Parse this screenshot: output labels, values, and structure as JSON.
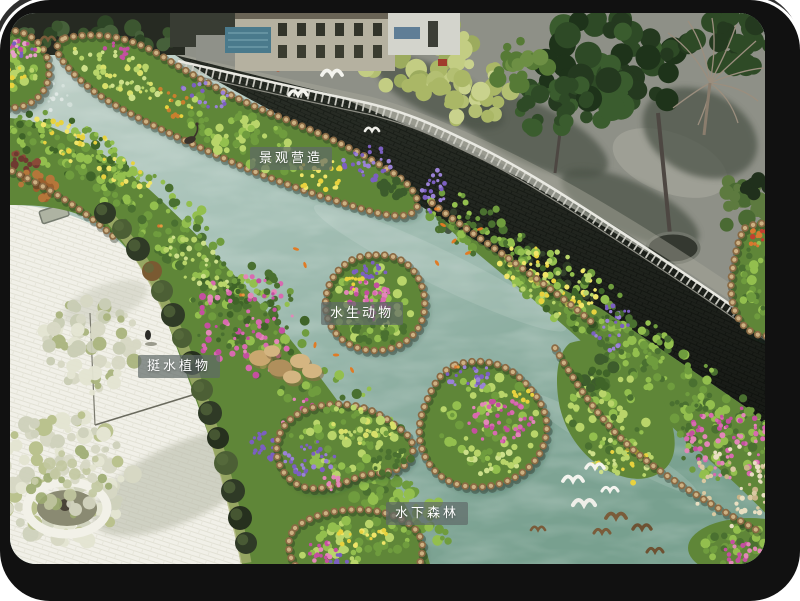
{
  "annotations": {
    "landscape_creation": "景观营造",
    "aquatic_animals": "水生动物",
    "emergent_plants": "挺水植物",
    "underwater_forest": "水下森林"
  },
  "colors": {
    "frame": "#111111",
    "label_bg": "rgba(96,106,104,0.70)",
    "label_text": "#ffffff",
    "water_top": "#c6d4cc",
    "water_mid": "#a4bfb4",
    "water_bottom": "#78a08f",
    "plaza": "#f1f0e8",
    "wall": "#2c3129",
    "road": "#8e9087",
    "railing": "#e9e9e2",
    "island_base": "#5f8638",
    "green_dark": "#3f6428",
    "green_mid": "#6f9c3e",
    "green_bright": "#93bf4e",
    "green_light": "#b9d56a",
    "flower_magenta": "#c44fa0",
    "flower_pink": "#e287b8",
    "flower_purple": "#7b5fc0",
    "flower_yellow": "#e8d23e",
    "flower_orange": "#d87830",
    "log_dark": "#8a6a44",
    "log_light": "#cdb183",
    "koi": "#e07b25",
    "rock": "#c9a76f",
    "pampas": "#d9c9a2"
  }
}
